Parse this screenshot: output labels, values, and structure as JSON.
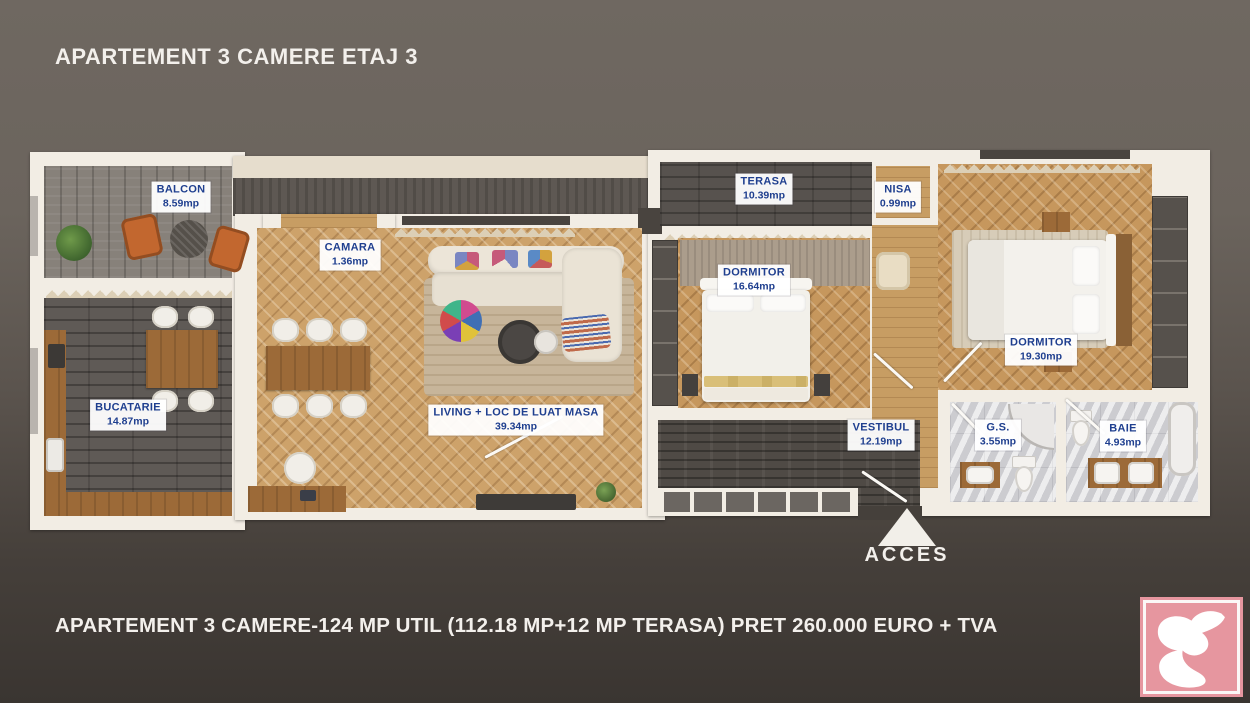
{
  "header": {
    "title": "APARTEMENT 3 CAMERE ETAJ 3"
  },
  "footer": {
    "summary": "APARTEMENT 3 CAMERE-124 MP UTIL (112.18 MP+12 MP TERASA) PRET 260.000 EURO + TVA"
  },
  "acces": {
    "label": "ACCES"
  },
  "rooms": [
    {
      "id": "balcon",
      "name": "BALCON",
      "area": "8.59mp"
    },
    {
      "id": "bucatarie",
      "name": "BUCATARIE",
      "area": "14.87mp"
    },
    {
      "id": "camara",
      "name": "CAMARA",
      "area": "1.36mp"
    },
    {
      "id": "living",
      "name": "LIVING + LOC DE LUAT MASA",
      "area": "39.34mp"
    },
    {
      "id": "terasa",
      "name": "TERASA",
      "area": "10.39mp"
    },
    {
      "id": "dormitor1",
      "name": "DORMITOR",
      "area": "16.64mp"
    },
    {
      "id": "nisa",
      "name": "NISA",
      "area": "0.99mp"
    },
    {
      "id": "dormitor2",
      "name": "DORMITOR",
      "area": "19.30mp"
    },
    {
      "id": "vestibul",
      "name": "VESTIBUL",
      "area": "12.19mp"
    },
    {
      "id": "gs",
      "name": "G.S.",
      "area": "3.55mp"
    },
    {
      "id": "baie",
      "name": "BAIE",
      "area": "4.93mp"
    }
  ],
  "colors": {
    "label_text": "#1f3f8f",
    "label_bg": "#ffffff",
    "wall": "#f2ede4",
    "background_top": "#6f6861",
    "background_bottom": "#3a3531",
    "logo_pink": "#e6969f",
    "wood_floor": "#cda26a"
  }
}
